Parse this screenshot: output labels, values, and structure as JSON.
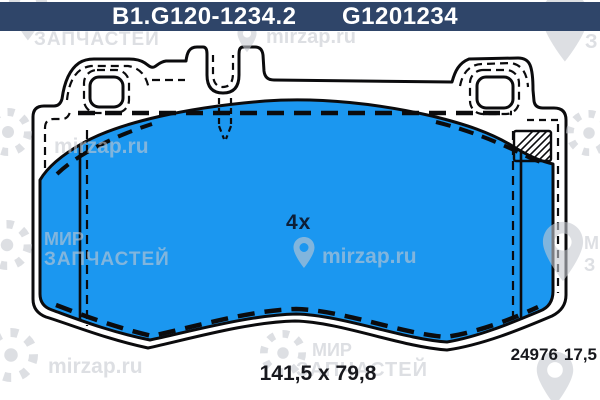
{
  "part": {
    "number_primary": "B1.G120-1234.2",
    "number_secondary": "G1201234",
    "quantity": "4x",
    "dimensions": "141,5 x 79,8",
    "wva_number": "24976",
    "thickness": "17,5"
  },
  "watermark": {
    "brand_word1": "МИР",
    "brand_word2": "ЗАПЧАСТЕЙ",
    "site": "mirzap.ru",
    "fragment_z": "З",
    "fragment_m": "М"
  },
  "colors": {
    "header_bg": "#2F4569",
    "header_text": "#FFFFFF",
    "pad_fill": "#1B97F0",
    "outline": "#0B0B0D",
    "label_text": "#17181D",
    "quantity_text": "#0D1F38"
  }
}
